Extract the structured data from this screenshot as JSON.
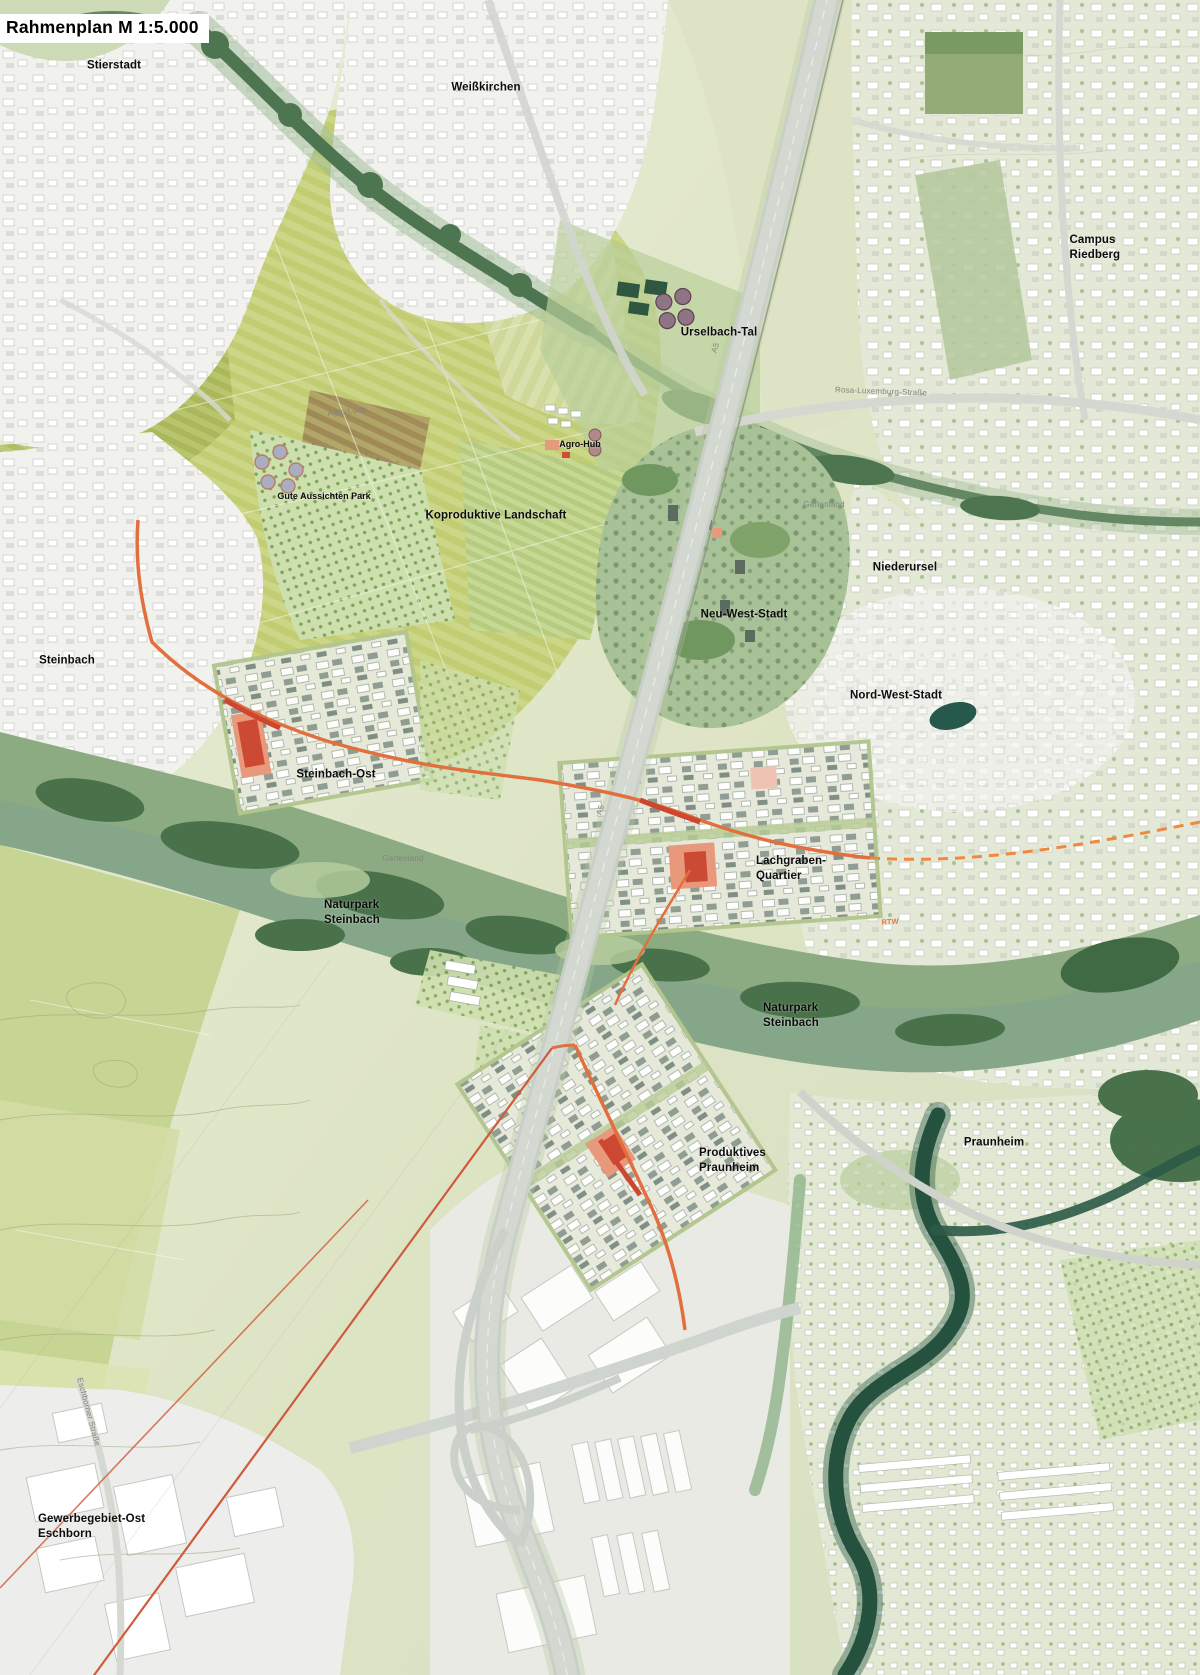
{
  "title": "Rahmenplan M 1:5.000",
  "map": {
    "colors": {
      "field_light": "#d9e0ad",
      "field_mid": "#c6d285",
      "field_dark": "#aebc62",
      "urban_white": "#f1f1ee",
      "urban_pale_green": "#e4e9d7",
      "forest_dark": "#49724a",
      "naturpark_green": "#8cab83",
      "river_dark": "#24523f",
      "motorway_gray": "#cbd1ca",
      "route_orange": "#e2703f",
      "route_red": "#cc4630",
      "quarter_salmon": "#e8997c",
      "label_black": "#0c0c0c",
      "label_gray": "#82857a"
    },
    "labels": [
      {
        "id": "stierstadt",
        "text": "Stierstadt",
        "x": 114,
        "y": 66,
        "anchor": "c",
        "cls": "place"
      },
      {
        "id": "weisskirchen",
        "text": "Weißkirchen",
        "x": 486,
        "y": 88,
        "anchor": "c",
        "cls": "place"
      },
      {
        "id": "campus-riedberg",
        "text": "Campus Riedberg",
        "x": 1113,
        "y": 248,
        "anchor": "c",
        "cls": "place"
      },
      {
        "id": "urselbach-tal",
        "text": "Urselbach-Tal",
        "x": 719,
        "y": 333,
        "anchor": "c",
        "cls": "place"
      },
      {
        "id": "agro-hub",
        "text": "Agro-Hub",
        "x": 580,
        "y": 445,
        "anchor": "c",
        "cls": "place-sm"
      },
      {
        "id": "gute-aussichten-park",
        "text": "Gute Aussichten Park",
        "x": 324,
        "y": 497,
        "anchor": "c",
        "cls": "place-sm"
      },
      {
        "id": "koproduktive-landschaft",
        "text": "Koproduktive Landschaft",
        "x": 496,
        "y": 516,
        "anchor": "c",
        "cls": "place"
      },
      {
        "id": "niederursel",
        "text": "Niederursel",
        "x": 905,
        "y": 568,
        "anchor": "c",
        "cls": "place"
      },
      {
        "id": "neu-west-stadt",
        "text": "Neu-West-Stadt",
        "x": 744,
        "y": 615,
        "anchor": "c",
        "cls": "place"
      },
      {
        "id": "steinbach",
        "text": "Steinbach",
        "x": 67,
        "y": 661,
        "anchor": "c",
        "cls": "place"
      },
      {
        "id": "nord-west-stadt",
        "text": "Nord-West-Stadt",
        "x": 896,
        "y": 696,
        "anchor": "c",
        "cls": "place"
      },
      {
        "id": "steinbach-ost",
        "text": "Steinbach-Ost",
        "x": 336,
        "y": 775,
        "anchor": "c",
        "cls": "place"
      },
      {
        "id": "lachgraben-quartier",
        "text": "Lachgraben-\nQuartier",
        "x": 756,
        "y": 854,
        "anchor": "l",
        "cls": "place"
      },
      {
        "id": "naturpark-steinbach-west",
        "text": "Naturpark\nSteinbach",
        "x": 324,
        "y": 898,
        "anchor": "l",
        "cls": "place"
      },
      {
        "id": "naturpark-steinbach-ost",
        "text": "Naturpark\nSteinbach",
        "x": 763,
        "y": 1001,
        "anchor": "l",
        "cls": "place"
      },
      {
        "id": "praunheim",
        "text": "Praunheim",
        "x": 994,
        "y": 1143,
        "anchor": "c",
        "cls": "place"
      },
      {
        "id": "produktives-praunheim",
        "text": "Produktives\nPraunheim",
        "x": 699,
        "y": 1146,
        "anchor": "l",
        "cls": "place"
      },
      {
        "id": "gewerbegebiet-ost-eschborn",
        "text": "Gewerbegebiet-Ost\nEschborn",
        "x": 38,
        "y": 1512,
        "anchor": "l",
        "cls": "place"
      },
      {
        "id": "rosa-luxemburg-strasse",
        "text": "Rosa-Luxemburg-Straße",
        "x": 881,
        "y": 392,
        "anchor": "c",
        "cls": "road",
        "rotate": 2
      },
      {
        "id": "eschborner-strasse",
        "text": "Eschborner Straße",
        "x": 88,
        "y": 1412,
        "anchor": "c",
        "cls": "road",
        "rotate": 75
      },
      {
        "id": "gartenland-nord",
        "text": "Gartenland",
        "x": 824,
        "y": 505,
        "anchor": "c",
        "cls": "road"
      },
      {
        "id": "gartenland-sued",
        "text": "Gartenland",
        "x": 403,
        "y": 859,
        "anchor": "c",
        "cls": "road"
      },
      {
        "id": "agro-loop",
        "text": "Agro-Loop",
        "x": 347,
        "y": 412,
        "anchor": "c",
        "cls": "road",
        "rotate": -6
      },
      {
        "id": "a5-nord",
        "text": "A5",
        "x": 716,
        "y": 348,
        "anchor": "c",
        "cls": "road",
        "rotate": -72
      },
      {
        "id": "a5-sued",
        "text": "A5",
        "x": 601,
        "y": 810,
        "anchor": "c",
        "cls": "road",
        "rotate": -72
      },
      {
        "id": "rtw",
        "text": "RTW",
        "x": 890,
        "y": 922,
        "anchor": "c",
        "cls": "rtw",
        "rotate": -3
      }
    ]
  }
}
